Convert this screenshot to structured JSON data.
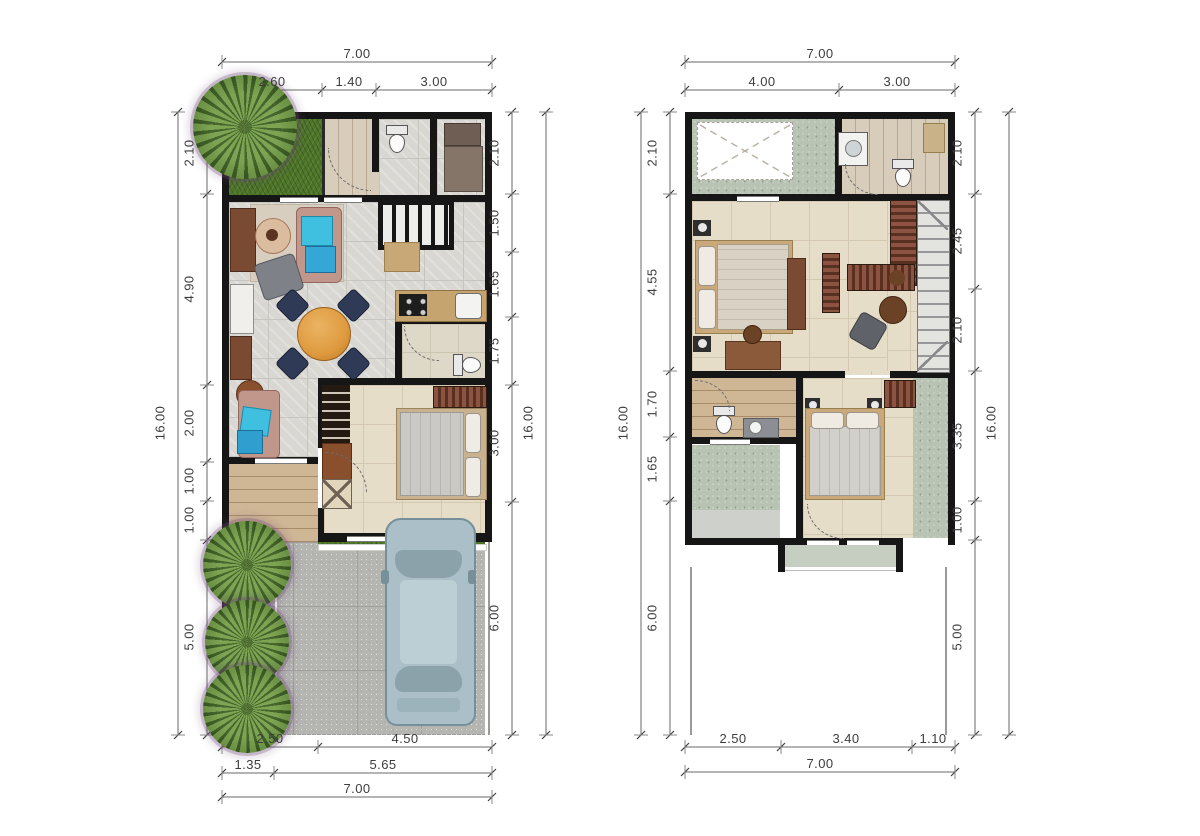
{
  "document": {
    "kind": "two-storey house floor plan drawing",
    "panels": [
      "ground-floor",
      "upper-floor"
    ]
  },
  "plans": [
    {
      "id": "ground-floor",
      "dims": {
        "top_overall": "7.00",
        "top_segments": [
          "2.60",
          "1.40",
          "3.00"
        ],
        "left_overall": "16.00",
        "left_segments": [
          "2.10",
          "4.90",
          "2.00",
          "1.00",
          "1.00",
          "5.00"
        ],
        "right_segments": [
          "2.10",
          "1.50",
          "1.65",
          "1.75",
          "3.00",
          "6.00"
        ],
        "right_overall": "16.00",
        "bottom_rows": [
          [
            "2.50",
            "4.50"
          ],
          [
            "1.35",
            "5.65"
          ]
        ],
        "bottom_overall": "7.00"
      }
    },
    {
      "id": "upper-floor",
      "dims": {
        "top_overall": "7.00",
        "top_segments": [
          "4.00",
          "3.00"
        ],
        "left_overall": "16.00",
        "left_segments": [
          "2.10",
          "4.55",
          "1.70",
          "1.65",
          "6.00"
        ],
        "right_segments": [
          "2.10",
          "2.45",
          "2.10",
          "3.35",
          "1.00",
          "5.00"
        ],
        "right_overall": "16.00",
        "bottom_rows": [
          [
            "2.50",
            "3.40",
            "1.10"
          ]
        ],
        "bottom_overall": "7.00"
      }
    }
  ],
  "colors": {
    "wall": "#161616",
    "grass": "#4d7628",
    "floor_tile": "#d9d7d2",
    "cream_tile": "#e6ddc9",
    "wood_deck": "#cfb695",
    "paving": "#b5b5b2",
    "roof_speckle": "#b9c3b3",
    "car_body": "#aabfc7",
    "sofa": "#c1968b",
    "pillow_accent": "#3fc0e0",
    "dining_table": "#df9a3e",
    "chair_navy": "#2f3a57",
    "wardrobe": "#8c5242",
    "dimension_text": "#3d3d3d"
  }
}
